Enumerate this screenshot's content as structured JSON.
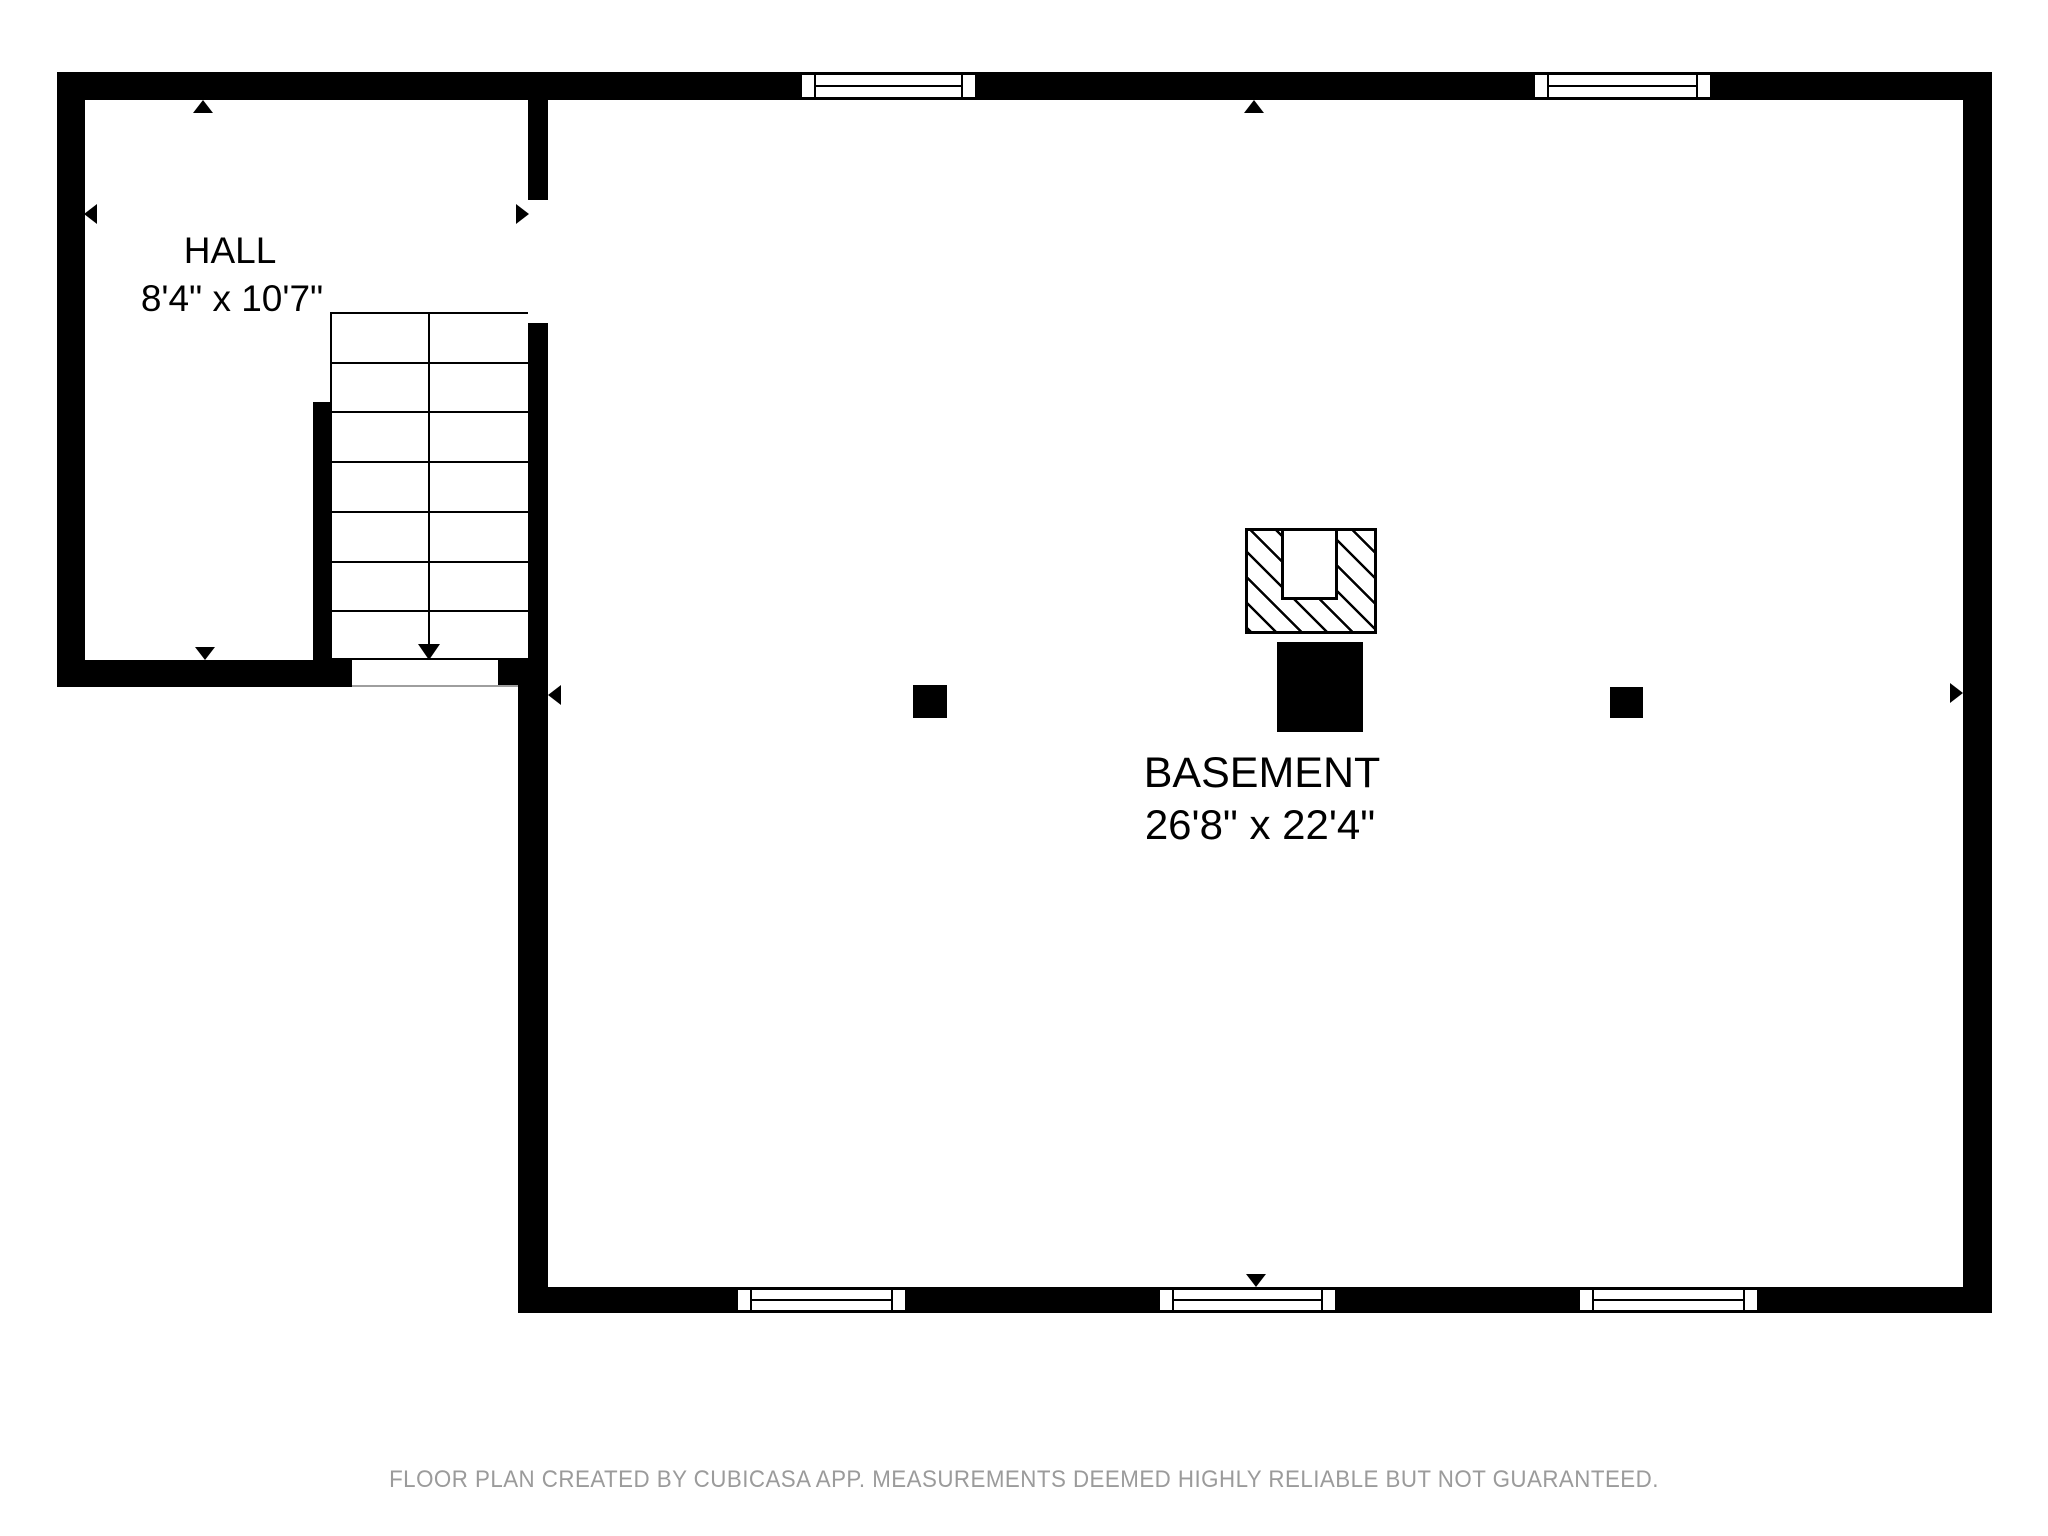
{
  "page": {
    "footer_disclaimer": "FLOOR PLAN CREATED BY CUBICASA APP. MEASUREMENTS DEEMED HIGHLY RELIABLE BUT NOT GUARANTEED."
  },
  "colors": {
    "wall": "#000000",
    "line": "#000000",
    "background": "#ffffff",
    "threshold_line": "#9e9e9e",
    "footer_text": "#9b9b9b"
  },
  "rooms": [
    {
      "id": "hall",
      "label": "HALL",
      "dimensions": "8'4\" x 10'7\""
    },
    {
      "id": "basement",
      "label": "BASEMENT",
      "dimensions": "26'8\" x 22'4\""
    }
  ],
  "plan": {
    "walls": [
      {
        "name": "top-exterior-wall",
        "x": 57,
        "y": 72,
        "w": 1935,
        "h": 28
      },
      {
        "name": "hall-left-exterior-wall",
        "x": 57,
        "y": 72,
        "w": 28,
        "h": 615
      },
      {
        "name": "right-exterior-wall",
        "x": 1963,
        "y": 72,
        "w": 29,
        "h": 1241
      },
      {
        "name": "bottom-exterior-wall",
        "x": 518,
        "y": 1287,
        "w": 1474,
        "h": 26
      },
      {
        "name": "hall-basement-divider-wall",
        "x": 528,
        "y": 100,
        "w": 20,
        "h": 560
      },
      {
        "name": "hall-bottom-wall",
        "x": 57,
        "y": 660,
        "w": 295,
        "h": 27
      },
      {
        "name": "stair-corner-block",
        "x": 498,
        "y": 660,
        "w": 50,
        "h": 27
      },
      {
        "name": "basement-left-exterior-wall",
        "x": 518,
        "y": 687,
        "w": 30,
        "h": 626
      },
      {
        "name": "stair-side-wall-stub",
        "x": 313,
        "y": 402,
        "w": 17,
        "h": 258
      }
    ],
    "door_openings": [
      {
        "name": "hall-to-basement-door-opening",
        "x": 528,
        "y": 200,
        "w": 20,
        "h": 123
      },
      {
        "name": "stair-bottom-door-opening",
        "x": 352,
        "y": 660,
        "w": 146,
        "h": 27
      }
    ],
    "threshold_lines": [
      {
        "x": 352,
        "y": 685,
        "w": 166,
        "h": 2
      }
    ],
    "windows": [
      {
        "name": "top-window-1",
        "x": 802,
        "y": 72,
        "w": 173,
        "h": 28
      },
      {
        "name": "top-window-2",
        "x": 1535,
        "y": 72,
        "w": 175,
        "h": 28
      },
      {
        "name": "bottom-window-1",
        "x": 738,
        "y": 1287,
        "w": 167,
        "h": 26
      },
      {
        "name": "bottom-window-2",
        "x": 1160,
        "y": 1287,
        "w": 175,
        "h": 26
      },
      {
        "name": "bottom-window-3",
        "x": 1580,
        "y": 1287,
        "w": 177,
        "h": 26
      }
    ],
    "stairs": {
      "x": 330,
      "y": 312,
      "w": 198,
      "h": 348,
      "steps": 7,
      "divider_x": 429,
      "arrow": {
        "shaft_top": 314,
        "shaft_bottom": 642,
        "tip_y": 658,
        "half_width": 11,
        "head_height": 16
      }
    },
    "chimney": {
      "hatched_base": {
        "x": 1245,
        "y": 528,
        "w": 132,
        "h": 106
      },
      "notch": {
        "x": 1281,
        "y": 528,
        "w": 57,
        "h": 72
      },
      "flue": {
        "x": 1277,
        "y": 642,
        "w": 86,
        "h": 90
      }
    },
    "posts": [
      {
        "x": 913,
        "y": 685,
        "w": 34,
        "h": 33
      },
      {
        "x": 1610,
        "y": 687,
        "w": 33,
        "h": 31
      }
    ],
    "measurement_arrows": [
      {
        "x": 203,
        "y": 100,
        "dir": "up"
      },
      {
        "x": 84,
        "y": 214,
        "dir": "left"
      },
      {
        "x": 205,
        "y": 660,
        "dir": "down"
      },
      {
        "x": 529,
        "y": 214,
        "dir": "right"
      },
      {
        "x": 1254,
        "y": 100,
        "dir": "up"
      },
      {
        "x": 1256,
        "y": 1287,
        "dir": "down"
      },
      {
        "x": 1963,
        "y": 693,
        "dir": "right"
      },
      {
        "x": 548,
        "y": 695,
        "dir": "left"
      }
    ],
    "arrow_size": {
      "half_width": 10,
      "length": 13
    }
  }
}
